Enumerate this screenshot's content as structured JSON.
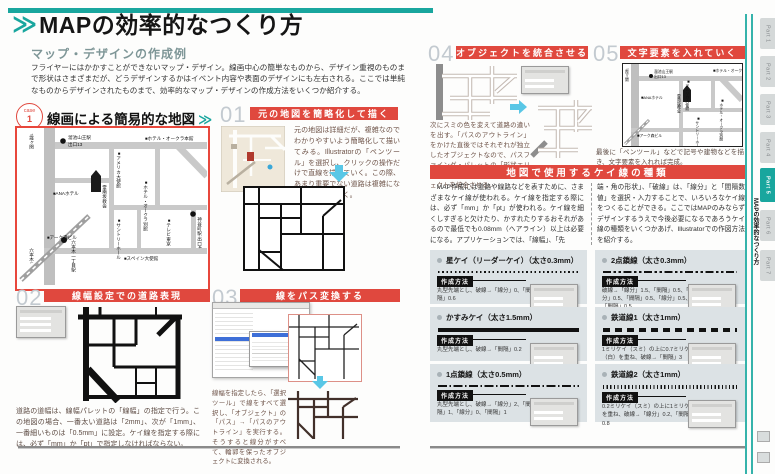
{
  "accent": {
    "teal": "#19a69e",
    "red": "#e0483e",
    "panel_gray": "#dce2e5"
  },
  "left_page": {
    "top_title": {
      "chevron": "≫",
      "title": "MAPの効率的なつくり方",
      "subtitle": "マップ・デザインの作成例"
    },
    "intro": "フライヤーにはかかすことができないマップ・デザイン。線画中心の簡単なものから、デザイン重視のものまで形状はさまざまだが、どうデザインするかはイベント内容や表面のデザインにも左右される。ここでは単純なものからデザインされたものまで、効率的なマップ・デザインの作成方法をいくつか紹介する。",
    "case1": {
      "label": "case",
      "number": "1",
      "heading": "線画による簡易的な地図",
      "chevron": "≫"
    },
    "s01": {
      "num": "01",
      "header": "元の地図を簡略化して描く",
      "caption": "元の地図は詳細だが、複雑なのでわかりやすいよう簡略化して描いてみる。Illustratorの「ペンツール」を選択し、クリックの操作だけで直線を描いていく。この際、あまり重要でない道路は複雑になるので省いておく。"
    },
    "s02": {
      "num": "02",
      "header": "線幅設定での道路表現",
      "caption": "道路の道幅は、線幅パレットの「線幅」の指定で行う。この地図の場合、一番太い道路は「2mm」、次が「1mm」、一番細いものは「0.5mm」に設定。ケイ線を指定する際には、必ず「mm」か「pt」で指定しなければならない。"
    },
    "s03": {
      "num": "03",
      "header": "線をパス変換する",
      "caption": "線幅を指定したら、「選択ツール」で線をすべて選択し、「オブジェクト」の「パス」→「パスのアウトライン」を実行する。そうすると線分がすべて、輪郭を保ったオブジェクトに変換される。"
    },
    "map_labels": {
      "kasumigaseki": "↑霞ヶ関",
      "tameike_line1": "溜池山王駅",
      "tameike_line2": "出口13",
      "america": "アメリカ大使館",
      "okura_main": "ホテル・オークラ本館",
      "ana": "ANAホテル",
      "reinanzaka": "霊南坂教会",
      "okura_annex": "ホテル・オークラ別館",
      "ark": "アーク森ビル",
      "suntory": "サントリーホール",
      "spain": "スペイン大使館",
      "tv_tokyo": "テレビ東京",
      "kamiyacho": "神谷町駅 出口4",
      "roppongi_itchome": "六本木一丁目駅",
      "roppongi": "六本木↓"
    }
  },
  "right_page": {
    "s04": {
      "num": "04",
      "header": "オブジェクトを統合させる",
      "caption": "次にスミの色を変えて道路の違いを出す。「パスのアウトライン」をかけた直後ではそれぞれが独立したオブジェクトなので、パスファインダ・パレットの「形状エリアの追加」をクリックしてオブジェクトを統合させる。"
    },
    "s05": {
      "num": "05",
      "header": "文字要素を入れていく",
      "caption": "最後に「ペンツール」などで記号や建物などを描き、文字要素を入れれば完成。"
    },
    "band_title": "地図で使用するケイ線の種類",
    "body_col1": "　MAP作成には道路や線路などを表すために、さまざまなケイ線が使われる。ケイ線を指定する際には、必ず「mm」か「pt」が使われる。ケイ線を細くしすぎると欠けたり、かすれたりするおそれがあるので最低でも0.08mm（ヘアライン）以上は必要になる。アプリケーションでは、「線幅」、「先",
    "body_col2": "端・角の形状」、「破線」は、「線分」と「間隔数値」を選択・入力することで、いろいろなケイ線をつくることができる。ここではMAPのみならずデザインするうえで今後必要になるであろうケイ線の種類をいくつかあげ、Illustratorでの作図方法を紹介する。",
    "method_label": "作成方法",
    "line_items": [
      {
        "title": "星ケイ（リーダーケイ）（太さ0.3mm）",
        "method": "丸型先端とし、破線→「線分」0、「間隔」0.6"
      },
      {
        "title": "かすみケイ（太さ1.5mm）",
        "method": "丸型先端とし、破線→「間隔」0.2"
      },
      {
        "title": "1点鎖線（太さ0.5mm）",
        "method": "丸型先端とし、破線→「線分」2、「間隔」1、「線分」0、「間隔」1"
      },
      {
        "title": "2点鎖線（太さ0.3mm）",
        "method": "破線→「線分」1.5、「間隔」0.5、「線分」0.5、「間隔」0.5、「線分」0.5、「間隔」0.5"
      },
      {
        "title": "鉄道線1（太さ1mm）",
        "method": "1ミリケイ（スミ）の上に0.7ミリケイ（白）を重ね、破線→「間隔」3"
      },
      {
        "title": "鉄道線2（太さ1mm）",
        "method": "0.2ミリケイ（スミ）の上に1ミリケイを重ね、破線→「線分」0.2、「間隔」0.8"
      }
    ]
  },
  "sidebar": {
    "tabs": [
      "Part 1",
      "Part 2",
      "Part 3",
      "Part 4",
      "Part 5",
      "Part 6",
      "Part 7"
    ],
    "active_index": 4,
    "chapter_label": "MAPの効率的なつくり方"
  }
}
